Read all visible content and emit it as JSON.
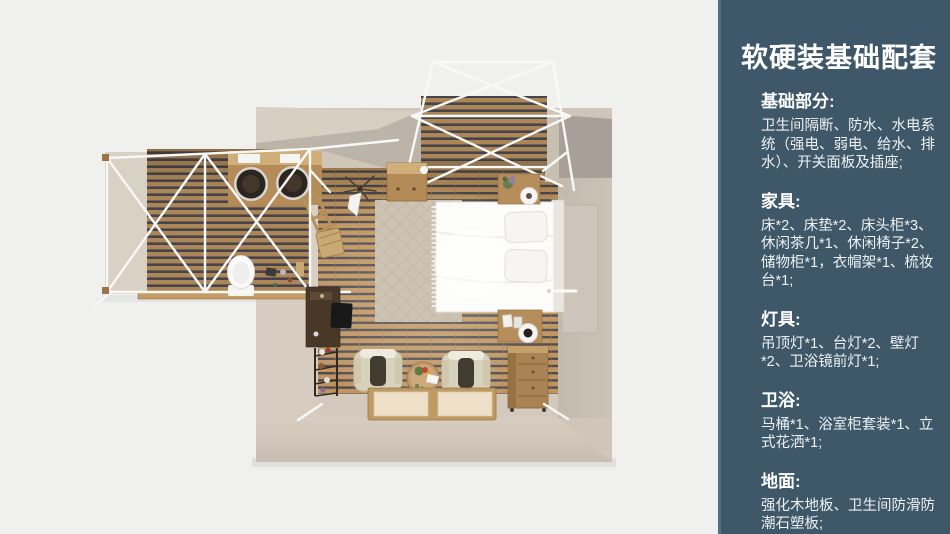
{
  "panel": {
    "bg_color": "#3e5869",
    "text_color": "#ffffff",
    "title": "软硬装基础配套",
    "sections": [
      {
        "heading": "基础部分:",
        "body": "卫生间隔断、防水、水电系统（强电、弱电、给水、排水）、开关面板及插座;"
      },
      {
        "heading": "家具:",
        "body": "床*2、床垫*2、床头柜*3、休闲茶几*1、休闲椅子*2、储物柜*1，衣帽架*1、梳妆台*1;"
      },
      {
        "heading": "灯具:",
        "body": "吊顶灯*1、台灯*2、壁灯*2、卫浴镜前灯*1;"
      },
      {
        "heading": "卫浴:",
        "body": "马桶*1、浴室柜套装*1、立式花洒*1;"
      },
      {
        "heading": "地面:",
        "body": "强化木地板、卫生间防滑防潮石塑板;"
      }
    ]
  },
  "floorplan": {
    "view": "top-down 3D room render",
    "areas": [
      "bedroom",
      "bathroom-wing",
      "balcony-deck"
    ],
    "items": [
      "double-bed",
      "pillows",
      "patterned-rug",
      "nightstand-with-lamp-top",
      "nightstand-with-lamp-bottom",
      "storage-dresser",
      "lounge-chair-left",
      "lounge-chair-right",
      "round-tea-table",
      "floor-mats",
      "dressing-table",
      "ladder-shelf",
      "coat-rack",
      "storage-cabinet",
      "bathroom-vanity-double-sink",
      "toilet",
      "white-steel-frame",
      "canopy-frame"
    ],
    "colors": {
      "background": "#f0f0ef",
      "wall_beige": "#d2c9bb",
      "wall_shadow": "#a8a098",
      "wood_floor": "#bf945f",
      "frame_white": "#f8f8f7",
      "ground_gray": "#c9c9c6"
    }
  }
}
